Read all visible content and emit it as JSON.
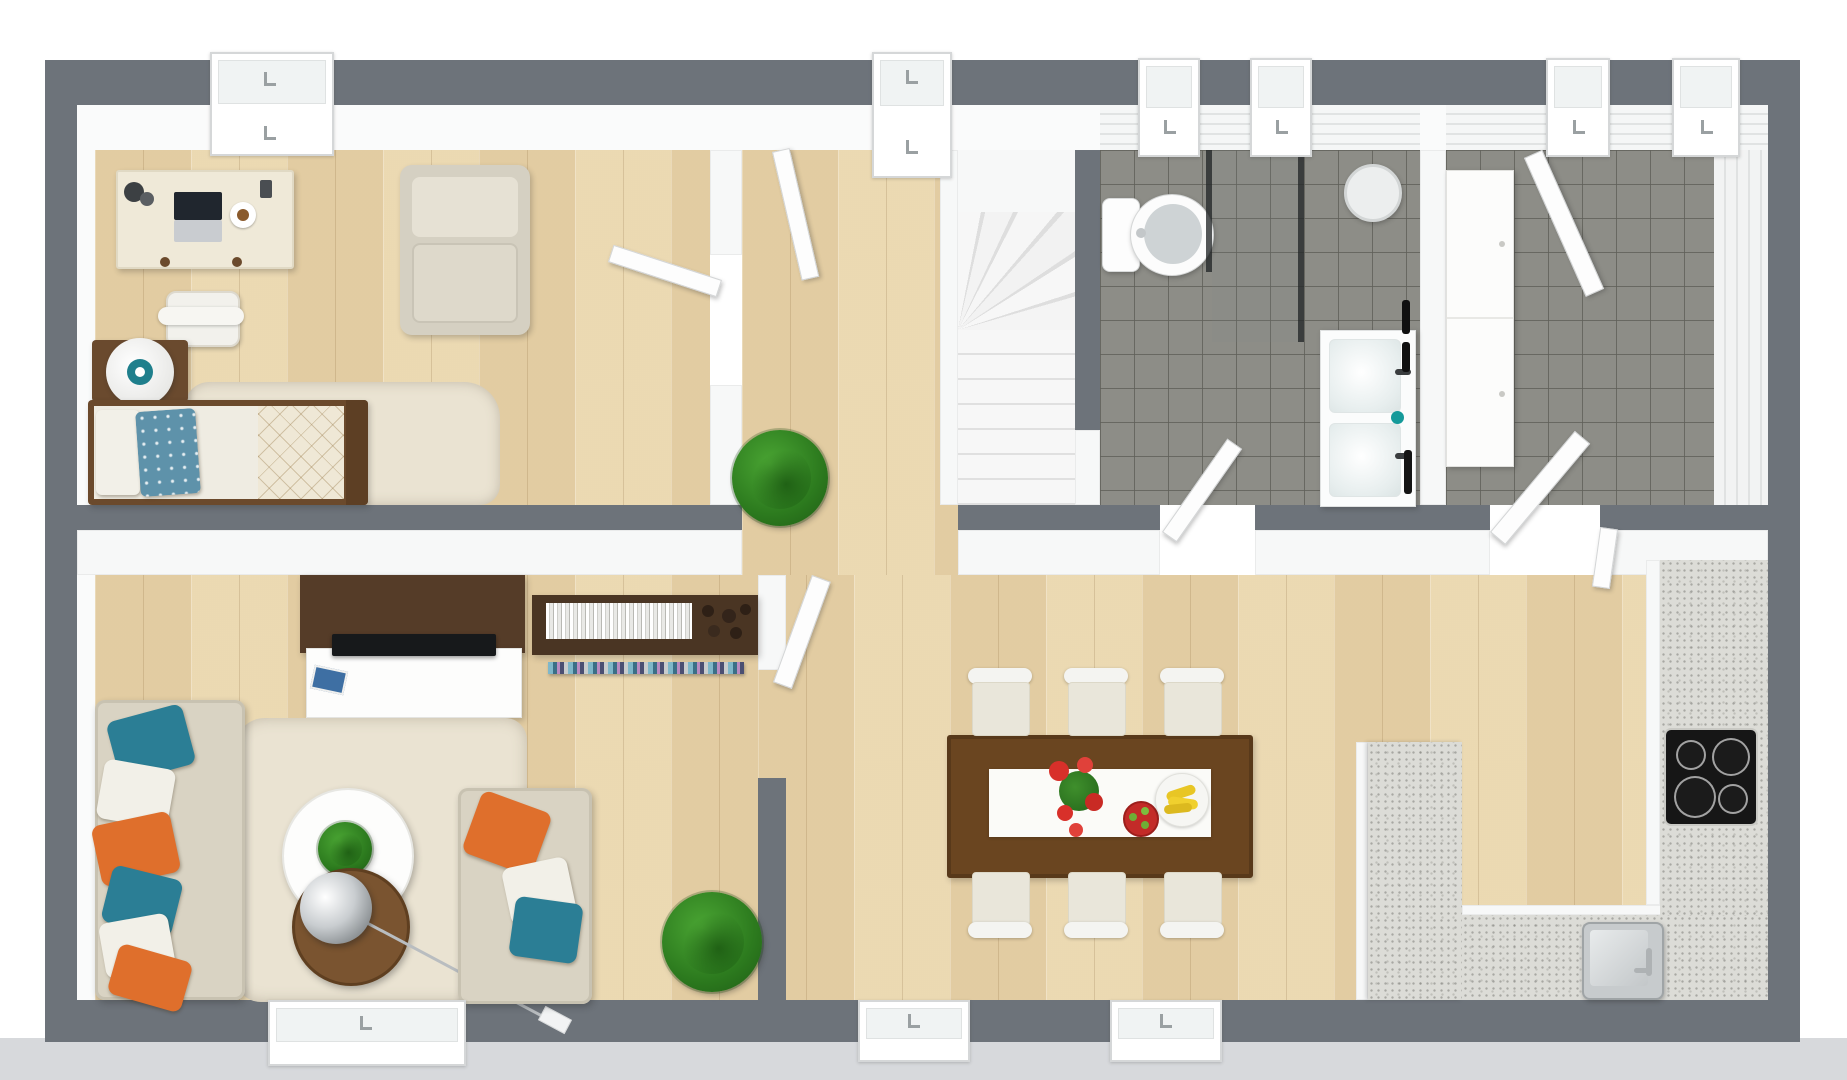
{
  "scene": {
    "title": "3D rendered floor plan, top-down view",
    "description": "Photorealistic one-level apartment floor plan render with no text labels",
    "view": "top-down orthographic"
  },
  "palette": {
    "exterior_wall": "#6d737a",
    "interior_wall": "#f7f8f8",
    "wood_floor": "#ead8b2",
    "tile_floor": "#8d8d87",
    "stair_white": "#f4f4f4",
    "counter_speckle": "#dcdcd7",
    "rug_cream": "#eae3d2",
    "sofa_beige": "#d9d3c3",
    "accent_teal": "#2b7e95",
    "accent_orange": "#df6f2c",
    "dark_wood": "#5d4226",
    "dining_table_wood": "#6a4520",
    "plant_green": "#3a8f28",
    "cooktop_black": "#161616",
    "ground_strip": "#d7d9dc"
  },
  "rooms": [
    {
      "id": "bedroom",
      "label": "Bedroom / home office",
      "floor": "wood",
      "furniture": [
        "desk with laptop, coffee cup and accessories",
        "desk chair",
        "beige armchair",
        "nightstand with sphere lamp",
        "bed with blue floral pillow and quilted duvet",
        "cream rug",
        "window bay",
        "open door leaf"
      ]
    },
    {
      "id": "hallway",
      "label": "Entry hallway",
      "floor": "wood",
      "furniture": [
        "front entry door bay",
        "open interior door",
        "potted plant"
      ]
    },
    {
      "id": "staircase",
      "label": "Winder staircase",
      "floor": "white",
      "furniture": [
        "upper landing",
        "fan winder treads",
        "straight treads"
      ]
    },
    {
      "id": "bathroom",
      "label": "Bathroom",
      "floor": "gray tile",
      "furniture": [
        "toilet",
        "glass shower screens",
        "double-sink vanity",
        "round mirror",
        "black towel rails",
        "teal tumbler",
        "two window bays"
      ]
    },
    {
      "id": "utility",
      "label": "Utility room",
      "floor": "gray tile",
      "furniture": [
        "tall white cabinet",
        "open door leaf",
        "two window bays",
        "panelled wall"
      ]
    },
    {
      "id": "living",
      "label": "Living room",
      "floor": "wood",
      "furniture": [
        "dark wood TV wall panel",
        "white media cabinet",
        "flat TV",
        "wall bookshelf with white books and round ornaments",
        "CD shelf strip",
        "sofa with six accent pillows",
        "second sofa with three pillows",
        "oval white coffee table with plant",
        "round wooden side table",
        "chrome arc floor lamp",
        "cream shag rug",
        "large potted plant",
        "window bay"
      ]
    },
    {
      "id": "dining",
      "label": "Dining area",
      "floor": "wood",
      "furniture": [
        "dark wood dining table",
        "white table runner",
        "red flower centerpiece",
        "red fruit bowl",
        "plate of bananas",
        "six cream dining chairs",
        "two window bays"
      ]
    },
    {
      "id": "kitchen",
      "label": "Kitchen",
      "floor": "wood",
      "furniture": [
        "speckled peninsula counter",
        "bottom run counter with stainless sink and faucet",
        "right run counter with black cooktop",
        "white cabinet fronts",
        "door leaves to utility room"
      ]
    }
  ],
  "counts": {
    "dining_chairs": 6,
    "cooktop_burners": 4,
    "bathroom_sinks": 2,
    "sofa_pillows": 9,
    "bed_pillows": 2,
    "window_bays": 8,
    "interior_door_leaves": 6,
    "potted_plants": 3
  }
}
